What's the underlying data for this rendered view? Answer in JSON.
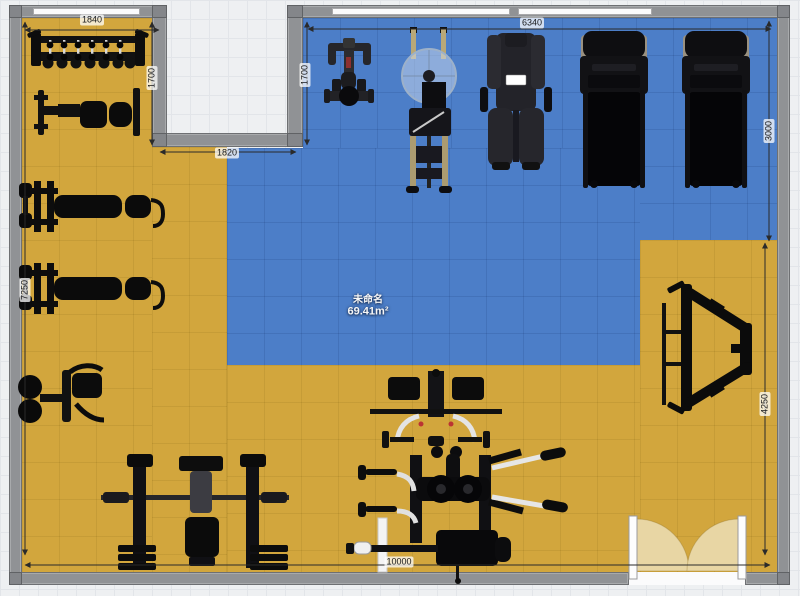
{
  "room": {
    "name": "未命名",
    "area": "69.41m²"
  },
  "dimensions": {
    "alcove_width": "1840",
    "alcove_depth": "1700",
    "step_depth": "1700",
    "notch_width": "1820",
    "upper_right_width": "6340",
    "right_upper_height": "3000",
    "right_lower_height": "4250",
    "left_height": "7250",
    "total_width": "10000"
  },
  "colors": {
    "floor_yellow": "#d2a63d",
    "floor_blue": "#4c7ec8",
    "wall_gray": "#909295",
    "door_swing": "#e8d6a4",
    "equipment_black": "#0d0d0d"
  },
  "equipment": [
    {
      "name": "dumbbell-rack"
    },
    {
      "name": "adjustable-bench"
    },
    {
      "name": "bench-press-station-1"
    },
    {
      "name": "bench-press-station-2"
    },
    {
      "name": "pec-deck-machine"
    },
    {
      "name": "power-rack-bench"
    },
    {
      "name": "multi-station-gym"
    },
    {
      "name": "leg-press-frame"
    },
    {
      "name": "spin-bike"
    },
    {
      "name": "rowing-machine"
    },
    {
      "name": "multi-gym"
    },
    {
      "name": "treadmill-1"
    },
    {
      "name": "treadmill-2"
    }
  ]
}
